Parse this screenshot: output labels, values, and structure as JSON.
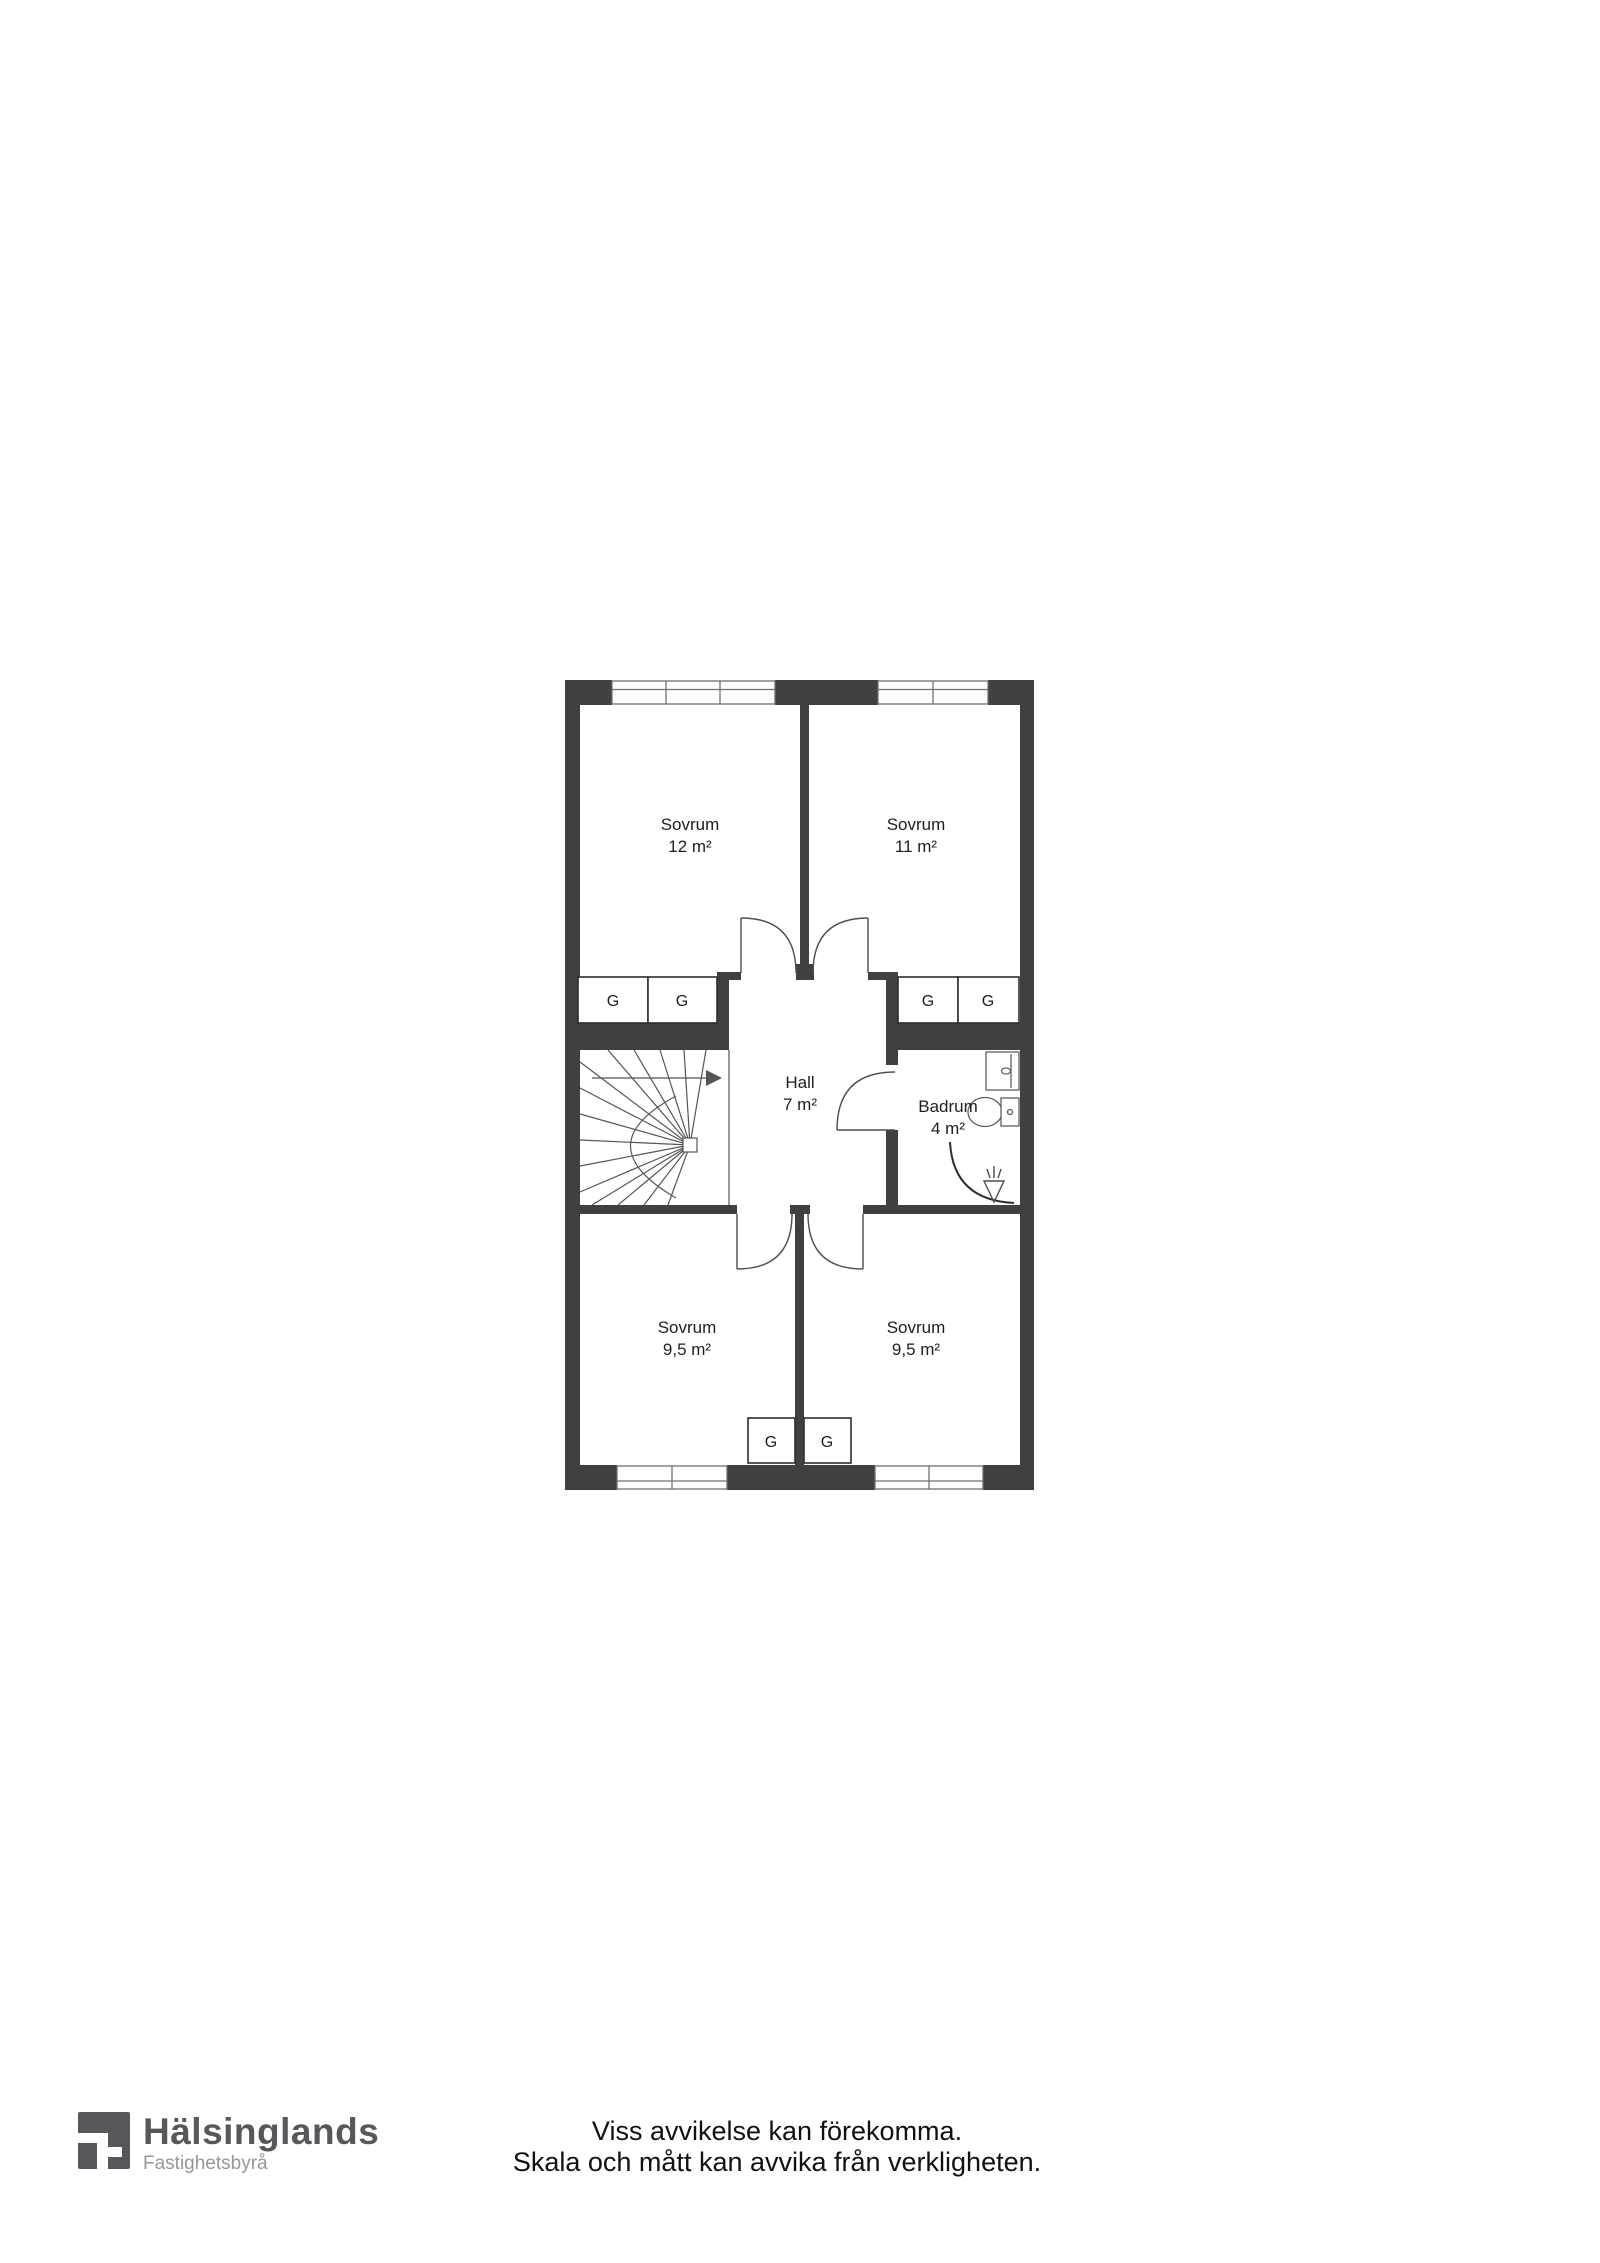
{
  "plan": {
    "rooms": {
      "bedroom_tl": {
        "name": "Sovrum",
        "area": "12 m²"
      },
      "bedroom_tr": {
        "name": "Sovrum",
        "area": "11 m²"
      },
      "hall": {
        "name": "Hall",
        "area": "7 m²"
      },
      "bathroom": {
        "name": "Badrum",
        "area": "4 m²"
      },
      "bedroom_bl": {
        "name": "Sovrum",
        "area": "9,5 m²"
      },
      "bedroom_br": {
        "name": "Sovrum",
        "area": "9,5 m²"
      }
    },
    "wardrobe_label": "G",
    "symbols": [
      "stairs",
      "stair-direction-arrow",
      "toilet",
      "sink-cabinet",
      "shower-corner",
      "floor-drain",
      "door-swing",
      "window"
    ],
    "colors": {
      "wall": "#404043",
      "line": "#4d4d4f",
      "fixture_line": "#5f5f62",
      "text": "#1e1e1e",
      "floor": "#ffffff"
    }
  },
  "branding": {
    "name": "Hälsinglands",
    "subtitle": "Fastighetsbyrå"
  },
  "disclaimer": {
    "line1": "Viss avvikelse kan förekomma.",
    "line2": "Skala och mått kan avvika från verkligheten."
  }
}
